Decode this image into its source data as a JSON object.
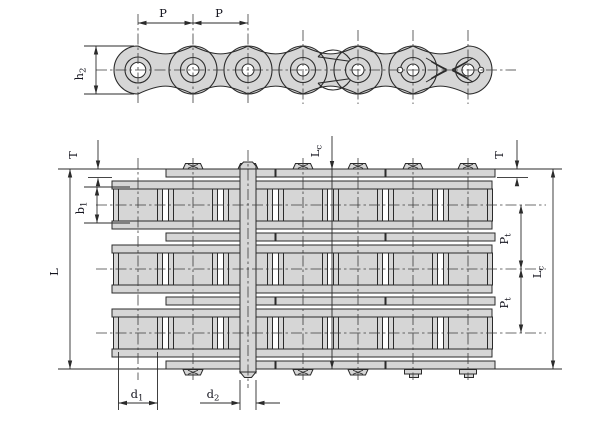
{
  "drawing": {
    "kind": "triplex-roller-chain-dimensional-drawing",
    "labels": {
      "p1": {
        "main": "P",
        "sub": ""
      },
      "p2": {
        "main": "P",
        "sub": ""
      },
      "h2": {
        "main": "h",
        "sub": "2"
      },
      "t_left": {
        "main": "T",
        "sub": ""
      },
      "lc_top": {
        "main": "L",
        "sub": "c"
      },
      "t_right": {
        "main": "T",
        "sub": ""
      },
      "b1": {
        "main": "b",
        "sub": "1"
      },
      "l": {
        "main": "L",
        "sub": ""
      },
      "pt_upper": {
        "main": "P",
        "sub": "t"
      },
      "pt_lower": {
        "main": "P",
        "sub": "t"
      },
      "lc_right": {
        "main": "L",
        "sub": "c"
      },
      "d1": {
        "main": "d",
        "sub": "1"
      },
      "d2": {
        "main": "d",
        "sub": "2"
      }
    },
    "colors": {
      "metal_fill": "#d6d6d6",
      "line": "#2b2b2b",
      "centerline": "#3c3c3c",
      "text": "#14141e",
      "background": "#ffffff"
    },
    "geometry": {
      "pin_xs": [
        138,
        193,
        248,
        303,
        358,
        413,
        468
      ],
      "strand_ys": [
        205,
        269,
        333
      ],
      "side_center_y": 70
    }
  }
}
